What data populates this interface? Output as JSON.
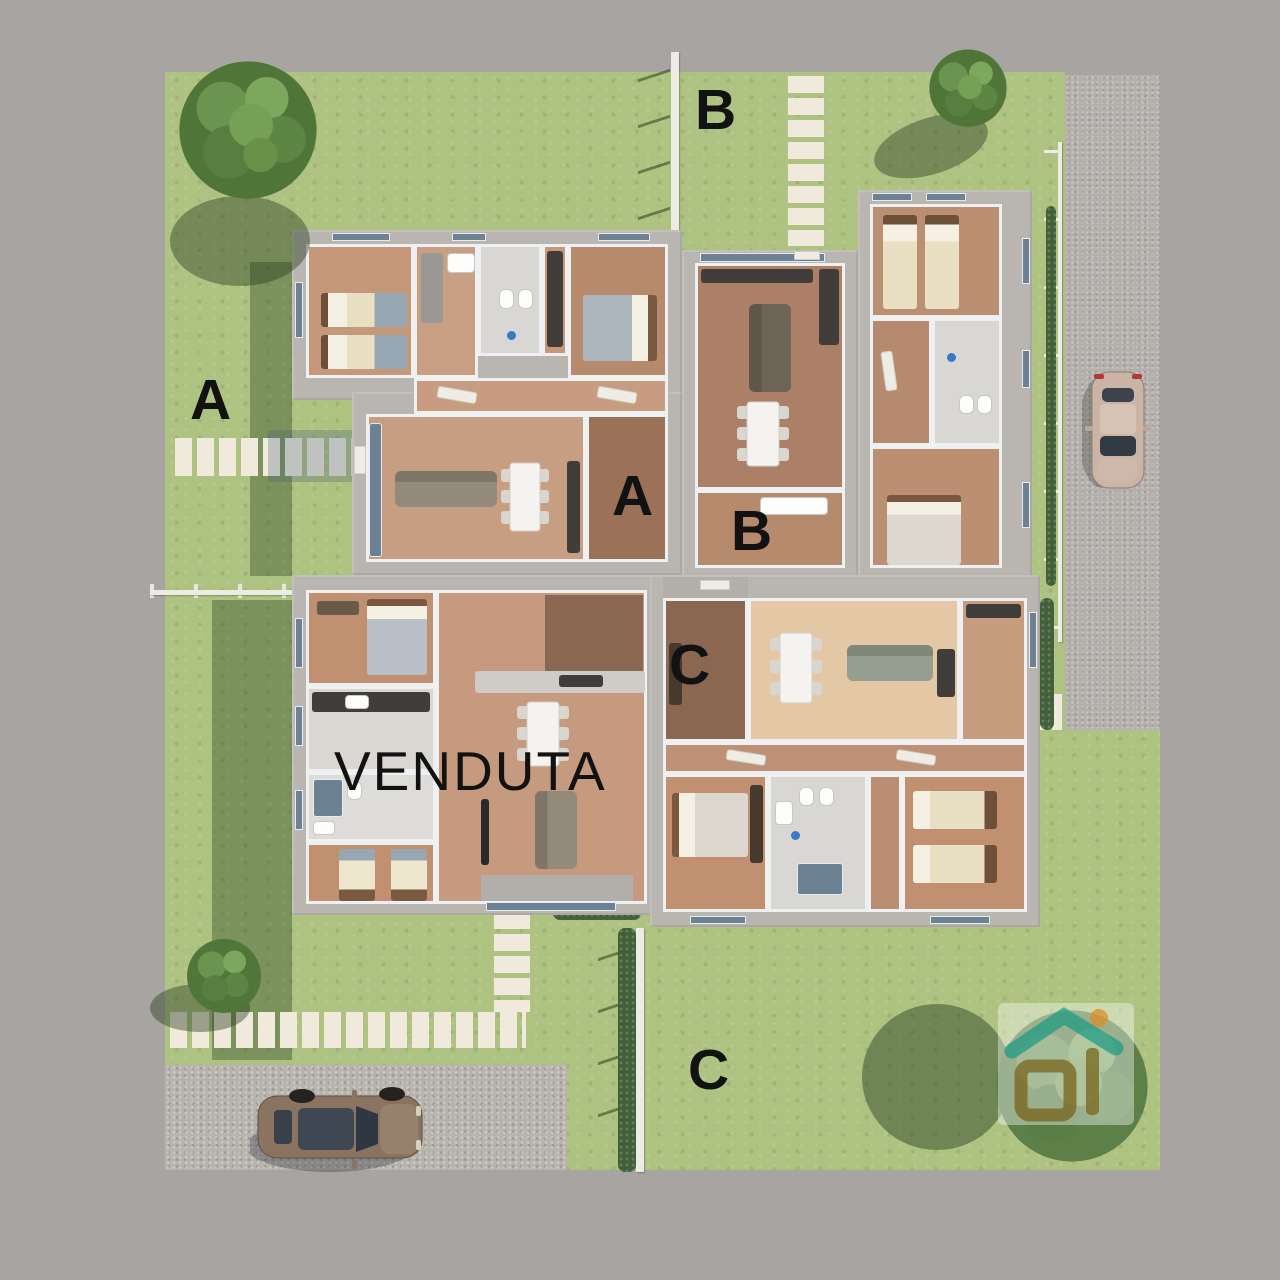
{
  "labels": {
    "garden_a": "A",
    "garden_b": "B",
    "garden_c": "C",
    "unit_a": "A",
    "unit_b": "B",
    "unit_c": "C",
    "sold": "VENDUTA"
  },
  "watermark": {
    "letters": "Di",
    "roof_color": "#2aa189",
    "sun_color": "#dd9330",
    "letters_color": "#7c671f",
    "panel_color": "rgba(255,255,255,0.42)"
  },
  "palette": {
    "border": "#a7a4a2",
    "lawn": "#aec381",
    "lawn_shadow": "#41603a",
    "stone": "#efeadb",
    "road": "#b4b1ad",
    "gravel": "#b7b3ad",
    "wall": "#b9b5b1",
    "inner_wall": "#eff0f2",
    "marble": "#d9d7d4",
    "wood_light": "#e4c7a4",
    "wood_mid": "#c1977b",
    "wood_red": "#b68a6d",
    "wood_dark": "#8b6751",
    "glass": "#6c8194",
    "label_ink": "#121212"
  }
}
